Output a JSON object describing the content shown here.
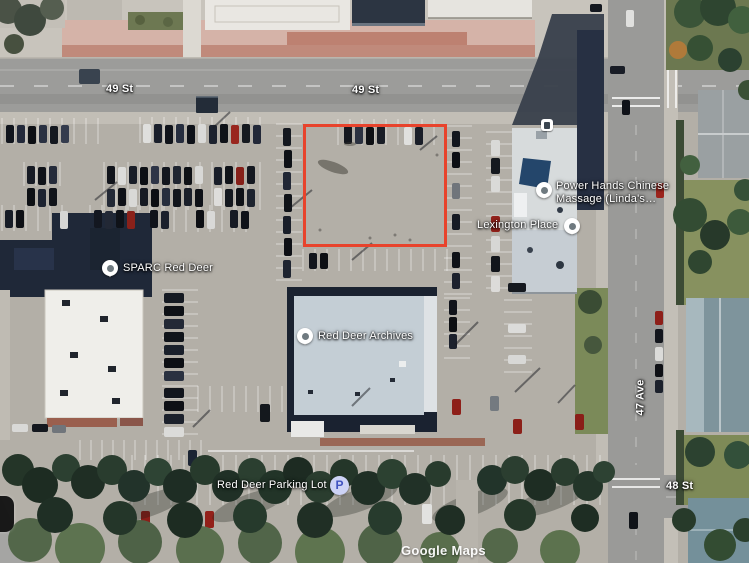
{
  "labels": {
    "street_49_a": "49 St",
    "street_49_b": "49 St",
    "street_47": "47 Ave",
    "street_48": "48 St"
  },
  "pois": {
    "sparc": "SPARC Red Deer",
    "power_hands_1": "Power Hands Chinese",
    "power_hands_2": "Massage (Linda's…",
    "lexington": "Lexington Place",
    "archives": "Red Deer Archives",
    "parking": "Red Deer Parking Lot P7",
    "parking_badge": "P"
  },
  "watermark": "Google Maps",
  "highlight": {
    "color": "#e8432c"
  },
  "theme": {
    "marker_ring": "#ffffff",
    "marker_dot": "#6f7a80",
    "badge_bg": "#cdd3f6",
    "badge_fg": "#4053c0",
    "label_color": "#ffffff"
  }
}
